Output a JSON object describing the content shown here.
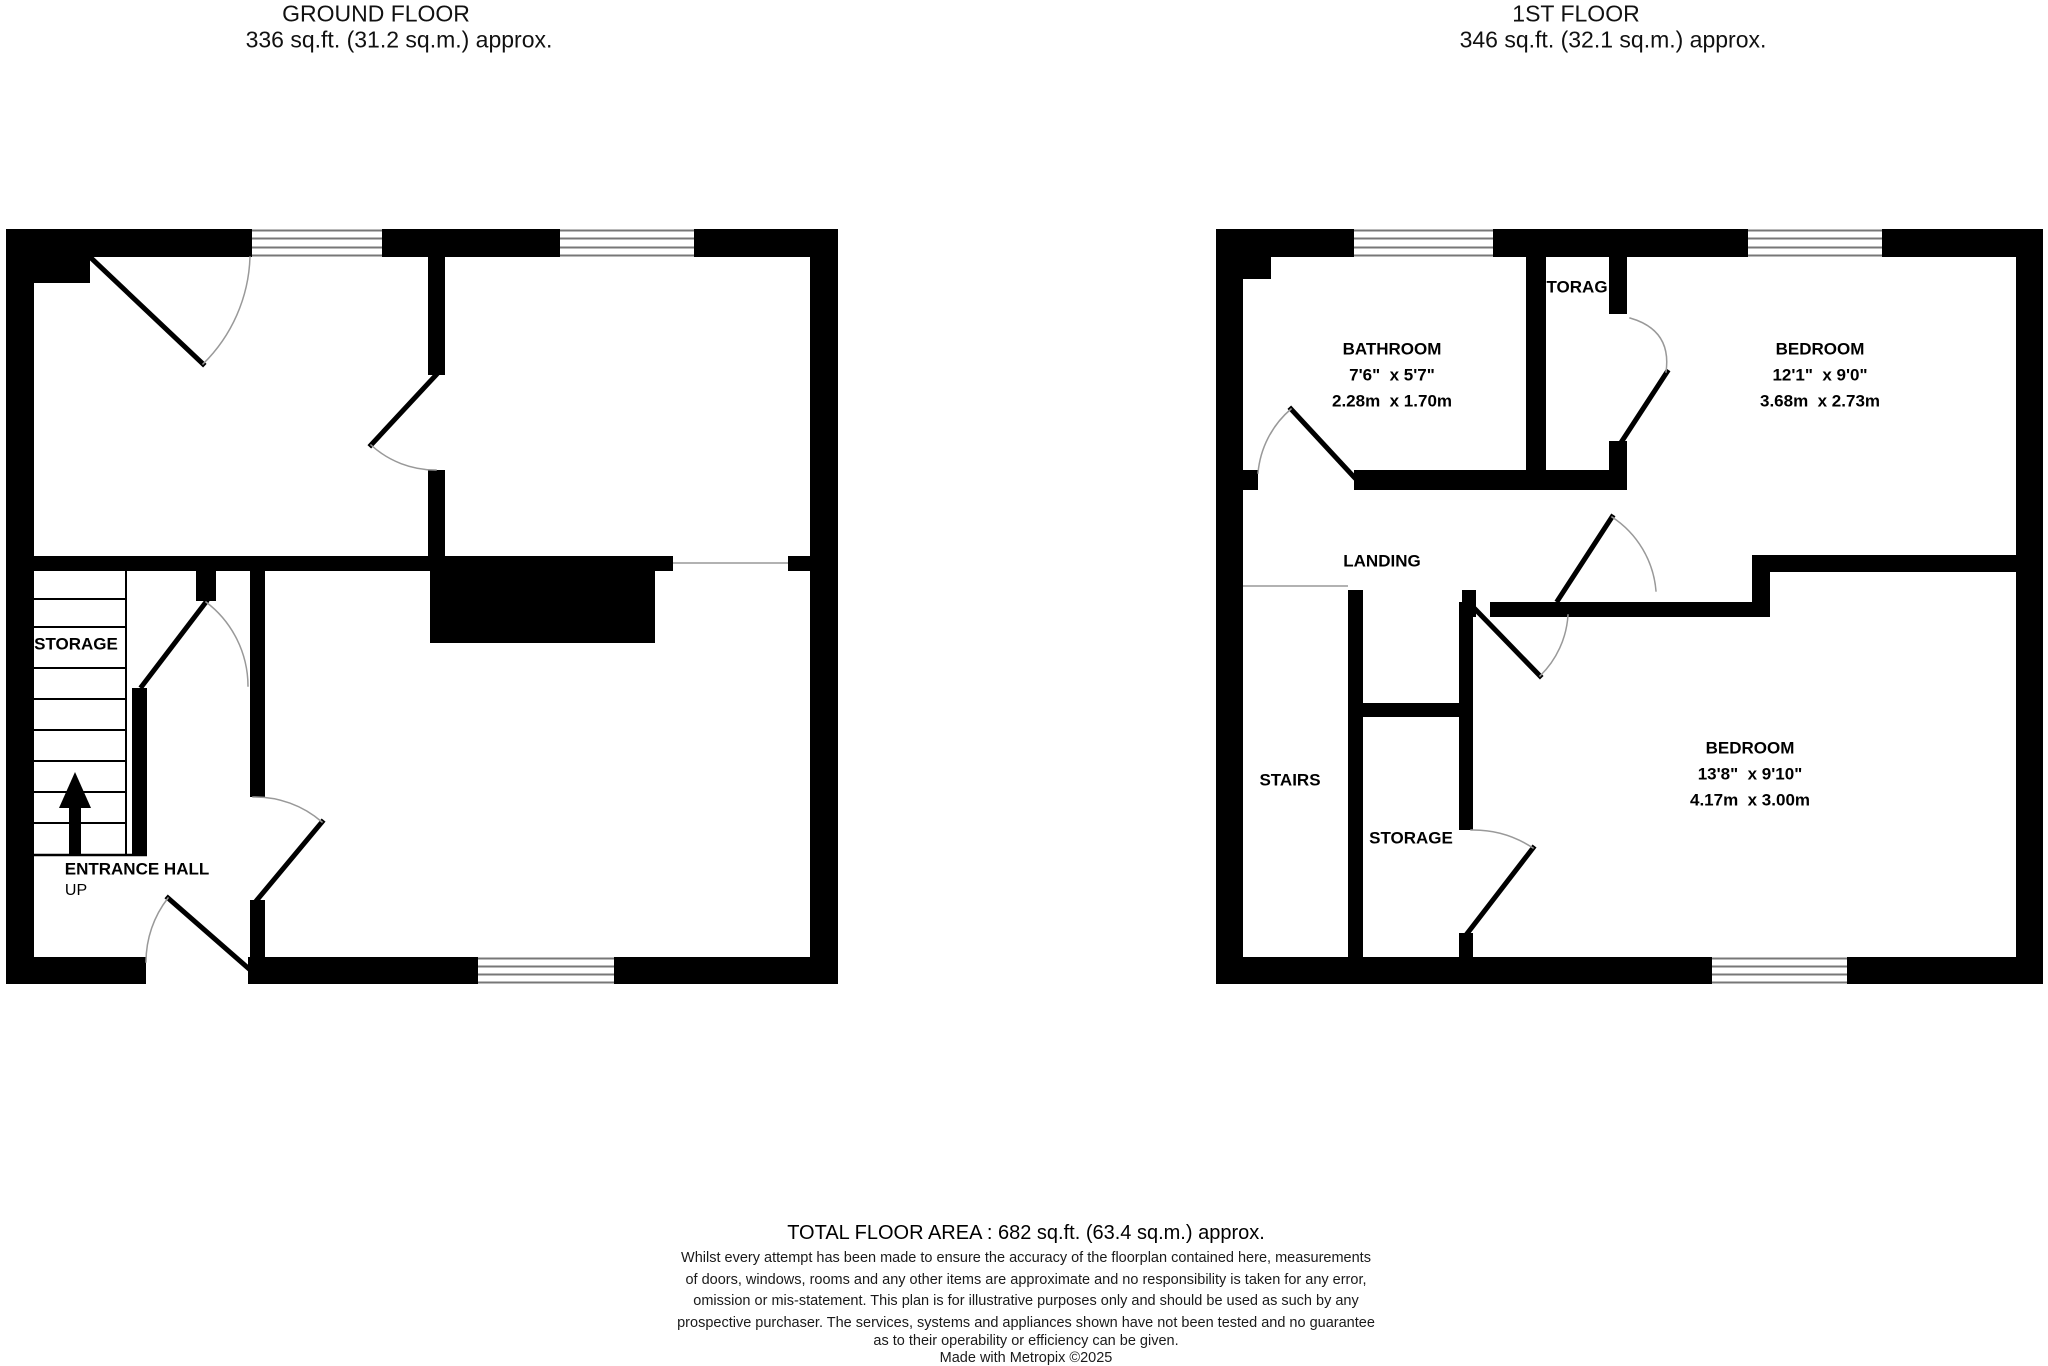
{
  "ground_floor": {
    "title": "GROUND FLOOR",
    "subtitle": "336 sq.ft. (31.2 sq.m.) approx.",
    "storage_label": "STORAGE",
    "entrance_hall_label": "ENTRANCE HALL",
    "up_label": "UP"
  },
  "first_floor": {
    "title": "1ST FLOOR",
    "subtitle": "346 sq.ft. (32.1 sq.m.) approx.",
    "bathroom": {
      "name": "BATHROOM",
      "size_imperial": "7'6\"  x 5'7\"",
      "size_metric": "2.28m  x 1.70m"
    },
    "storage_top_label": "TORAG",
    "bedroom1": {
      "name": "BEDROOM",
      "size_imperial": "12'1\"  x 9'0\"",
      "size_metric": "3.68m  x 2.73m"
    },
    "landing_label": "LANDING",
    "stairs_label": "STAIRS",
    "storage_label": "STORAGE",
    "bedroom2": {
      "name": "BEDROOM",
      "size_imperial": "13'8\"  x 9'10\"",
      "size_metric": "4.17m  x 3.00m"
    }
  },
  "footer": {
    "total_area": "TOTAL FLOOR AREA : 682 sq.ft. (63.4 sq.m.) approx.",
    "disclaimer_line1": "Whilst every attempt has been made to ensure the accuracy of the floorplan contained here, measurements",
    "disclaimer_line2": "of doors, windows, rooms and any other items are approximate and no responsibility is taken for any error,",
    "disclaimer_line3": "omission or mis-statement. This plan is for illustrative purposes only and should be used as such by any",
    "disclaimer_line4": "prospective purchaser. The services, systems and appliances shown have not been tested and no guarantee",
    "disclaimer_line5": "as to their operability or efficiency can be given.",
    "made_with": "Made with Metropix ©2025"
  },
  "colors": {
    "wall": "#000000",
    "arc": "#999999",
    "window_line": "#777777"
  }
}
